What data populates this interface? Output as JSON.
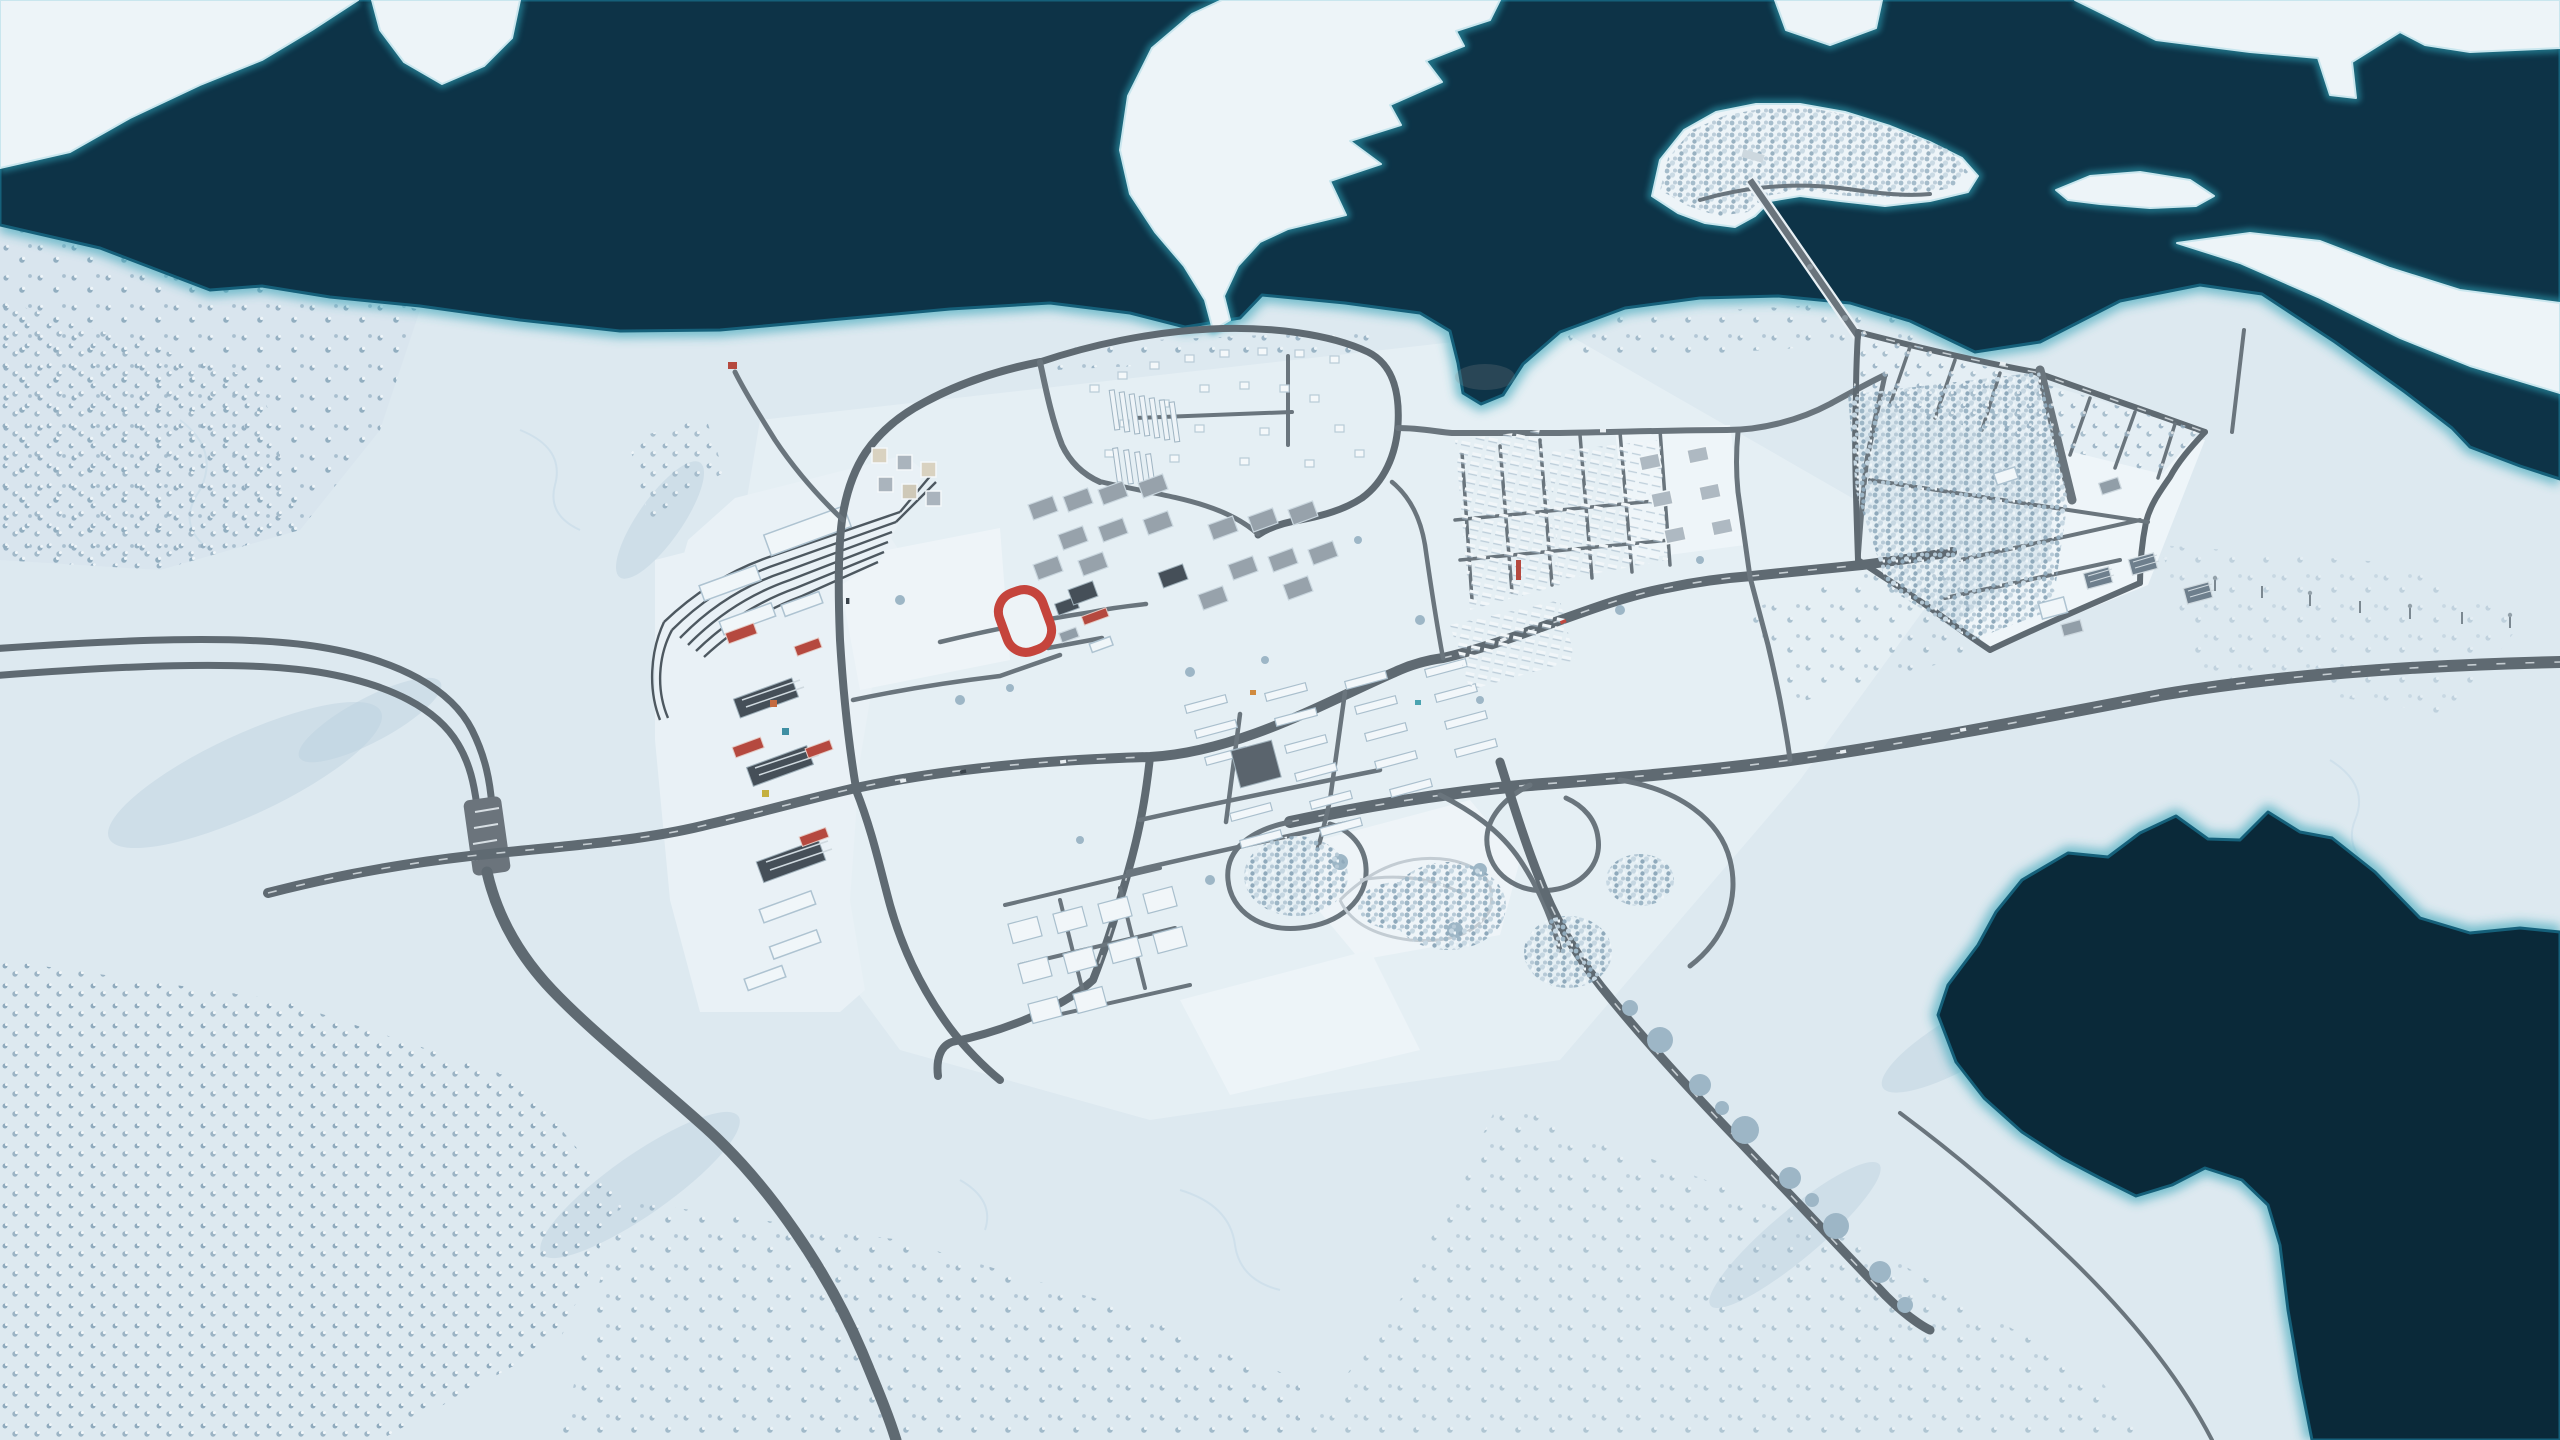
{
  "app": {
    "kind": "city-builder-game",
    "view": "aerial-map",
    "season": "winter",
    "hud_visible": false
  },
  "scene": {
    "label": "Aerial winter view of a snowy city between a dark sea channel and a frozen lake",
    "landmarks": [
      "sea-channel-north",
      "snow-peninsula",
      "forested-island",
      "island-bridge",
      "ice-floes-northeast",
      "rail-yard",
      "harbor-industrial-strip",
      "running-track",
      "north-residential-loop",
      "city-center-blocks",
      "northeast-row-housing",
      "highway-toll-plaza",
      "highway-interchange",
      "farm-forestry-district",
      "solar-panel-field",
      "frozen-lake-southeast",
      "power-line-pylons"
    ]
  },
  "colors": {
    "snow": "#dde9f0",
    "snowBright": "#edf4f8",
    "snowShade": "#c9dbe7",
    "water": "#0d3347",
    "waterDeep": "#0a2939",
    "waterGlow": "#2fa0b5",
    "waterEdge": "#15607a",
    "road": "#5f6a72",
    "roadMinor": "#6a757d",
    "rail": "#4d5860",
    "bldg": "#f0f6f9",
    "bldgEdge": "#aec3d1",
    "roofGray": "#919ea8",
    "roofDark": "#454f58",
    "roofRed": "#b5493f",
    "trackRed": "#c5443c",
    "tree": "#9db6c6",
    "treeShadow": "#b9cfdd",
    "parkPath": "#c3ccd3",
    "laneMark": "#d7dee3"
  }
}
